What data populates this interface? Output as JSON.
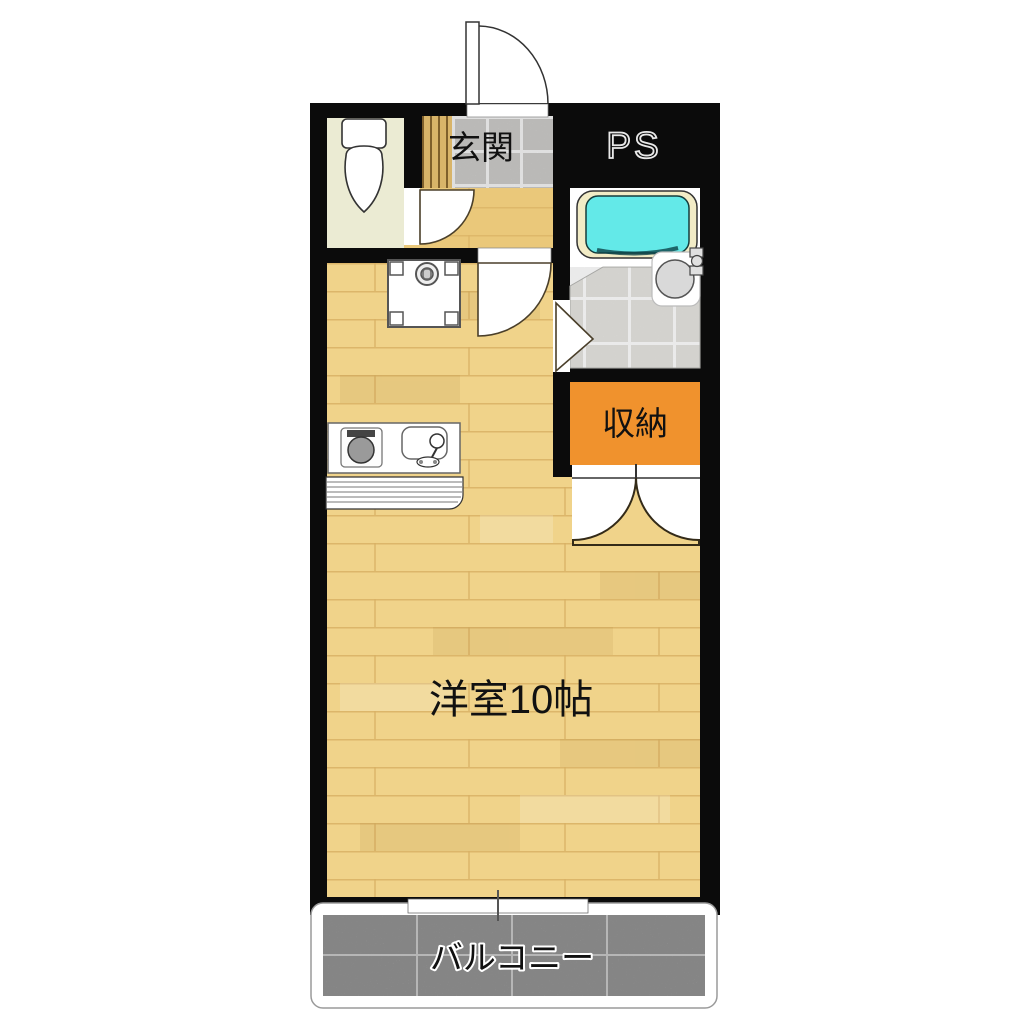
{
  "floorplan": {
    "labels": {
      "entrance": "玄関",
      "pipe_space": "PS",
      "storage": "収納",
      "main_room": "洋室10帖",
      "balcony": "バルコニー"
    },
    "colors": {
      "wall": "#0b0b0b",
      "wood_main": "#f0d38a",
      "wood_hall": "#eac87a",
      "plank_line": "#d3a85a",
      "toilet_floor": "#ebebd3",
      "step_wood": "#d8b469",
      "step_line": "#7e5f2b",
      "entrance_tile": "#d5d4d2",
      "bath_tile": "#e6e5e1",
      "grout": "#ffffff",
      "bathtub_water": "#63e9e8",
      "bathtub_rim": "#f2ecc6",
      "storage_orange": "#f0922d",
      "balcony_concrete": "#acacac",
      "door_line": "#4a3f2a",
      "label_text": "#111111"
    }
  }
}
